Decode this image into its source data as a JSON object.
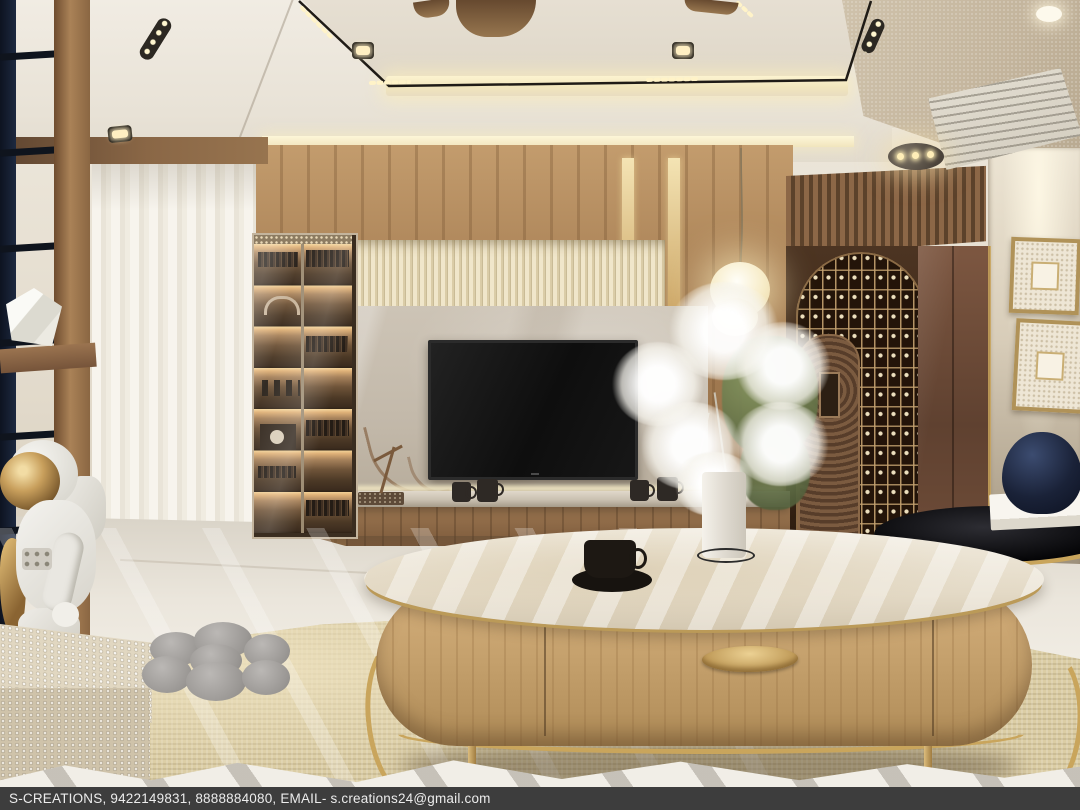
{
  "meta": {
    "type": "3d-interior-render",
    "subject": "Modern luxury living room with marble TV wall, arched wine rack and oval coffee table"
  },
  "watermark": {
    "text": "S-CREATIONS, 9422149831, 8888884080, EMAIL- s.creations24@gmail.com",
    "studio": "S-CREATIONS",
    "phones": [
      "9422149831",
      "8888884080"
    ],
    "email": "s.creations24@gmail.com"
  },
  "palette": {
    "ceiling": "#e9e3d8",
    "cove_glow": "#f7ecc6",
    "wood_wall": "#ab8257",
    "fluted_panel": "#e7ddc1",
    "marble_panel": "#c6bcae",
    "tv_screen": "#161616",
    "wine_wall": "#3c2817",
    "bronze_door": "#77503a",
    "gold_accent": "#c9a55c",
    "right_wall": "#d9cfbe",
    "floor": "#ede9e0",
    "rug": "#dbcda4",
    "table_wood": "#c9a672",
    "navy_accent": "#1a2238",
    "watermark_bar": "#3d3d3d"
  },
  "scene": {
    "objects": [
      "ceiling-fan",
      "recessed-downlights",
      "led-track-lights",
      "cove-lighting",
      "ac-cassette-vent",
      "ladder-partition",
      "white-curtain",
      "display-cabinet",
      "fluted-wall-panel",
      "marble-tv-panel",
      "wall-mounted-tv",
      "floating-media-shelf",
      "coffee-mugs",
      "bonsai-decor",
      "pendant-lamp",
      "white-blossom-vase",
      "arched-wine-rack",
      "bronze-door",
      "wall-art-frames",
      "black-side-table",
      "blue-glass-vase",
      "oval-coffee-table",
      "espresso-cup",
      "astronaut-figurine",
      "woven-ottoman",
      "flower-floor-cushion",
      "beige-area-rug"
    ]
  }
}
